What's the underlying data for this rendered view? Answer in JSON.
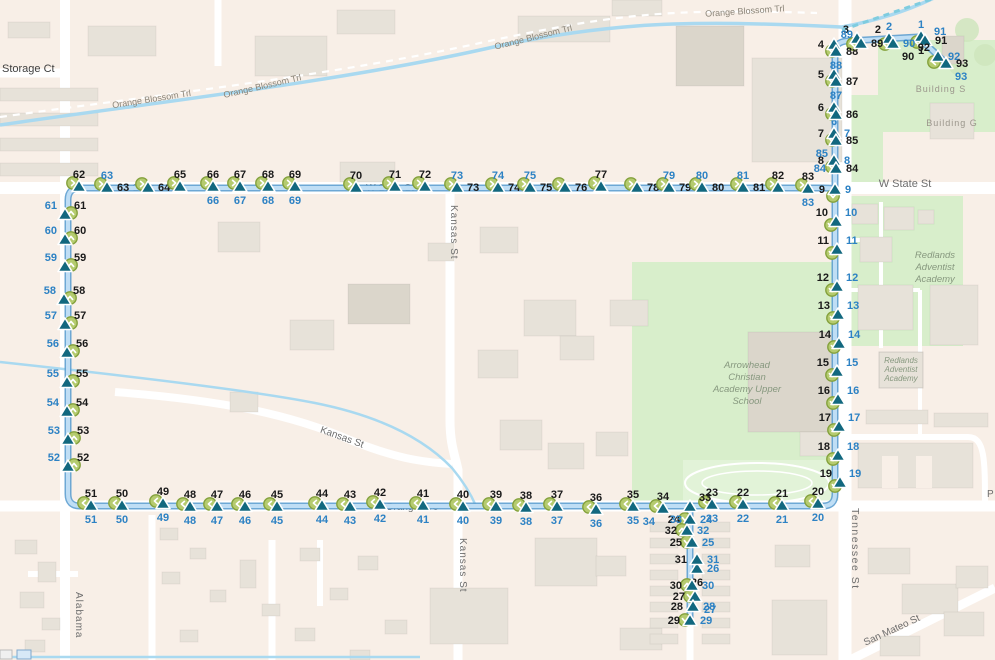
{
  "map": {
    "colors": {
      "bg": "#f8efe7",
      "building": "#e7e2d9",
      "buildingDark": "#dbd6cb",
      "road": "#ffffff",
      "green": "#d8eecb",
      "greenField": "#e2f3d8",
      "water": "#a9d9f0",
      "waterDash": "#7fccdf",
      "routeCasing": "#5d9fd0",
      "routeFill": "#bfdef5",
      "marker": "#12687f",
      "markerStroke": "#ffffff",
      "circleFill": "#b5cb6f",
      "circleRing": "#84a13c",
      "labelBlack": "#1a1a1a",
      "labelBlue": "#2d82c4",
      "labelDark": "#3f3f3f",
      "labelRoad": "#6e6e6e",
      "labelMinor": "#8a8478",
      "labelBuilding": "#9b968c",
      "labelArea": "#87987f"
    },
    "street_labels": [
      {
        "text": "Storage Ct",
        "x": 2,
        "y": 72,
        "size": 11,
        "cls": "dark",
        "anchor": "start"
      },
      {
        "text": "Orange Blossom Trl",
        "x": 152,
        "y": 102,
        "rot": -9,
        "size": 9,
        "cls": "minor",
        "anchor": "middle"
      },
      {
        "text": "Orange Blossom Trl",
        "x": 263,
        "y": 89,
        "rot": -13,
        "size": 9,
        "cls": "minor",
        "anchor": "middle"
      },
      {
        "text": "Orange Blossom Trl",
        "x": 534,
        "y": 40,
        "rot": -14,
        "size": 9,
        "cls": "minor",
        "anchor": "middle"
      },
      {
        "text": "Orange Blossom Trl",
        "x": 745,
        "y": 14,
        "rot": -4,
        "size": 9,
        "cls": "minor",
        "anchor": "middle"
      },
      {
        "text": "W State St",
        "x": 905,
        "y": 187,
        "size": 11,
        "cls": "road",
        "anchor": "middle"
      },
      {
        "text": "W State St",
        "x": 390,
        "y": 191,
        "size": 10,
        "cls": "road",
        "anchor": "middle",
        "under": true
      },
      {
        "text": "State St",
        "x": 150,
        "y": 191,
        "size": 10,
        "cls": "road",
        "anchor": "middle",
        "under": true
      },
      {
        "text": "Orange Ave",
        "x": 412,
        "y": 510,
        "size": 10,
        "cls": "road",
        "anchor": "middle",
        "under": true
      },
      {
        "text": "Kansas St",
        "x": 451,
        "y": 205,
        "rot": 90,
        "size": 10,
        "cls": "road",
        "anchor": "start",
        "spacing": 1
      },
      {
        "text": "Kansas St",
        "x": 341,
        "y": 440,
        "rot": 20,
        "size": 10,
        "cls": "road",
        "anchor": "middle"
      },
      {
        "text": "Kansas St",
        "x": 460,
        "y": 538,
        "rot": 90,
        "size": 10,
        "cls": "road",
        "anchor": "start",
        "spacing": 1
      },
      {
        "text": "Tennessee St",
        "x": 852,
        "y": 508,
        "rot": 90,
        "size": 10.5,
        "cls": "road",
        "anchor": "start",
        "spacing": 1.5
      },
      {
        "text": "Alabama",
        "x": 76,
        "y": 592,
        "rot": 90,
        "size": 10,
        "cls": "road",
        "anchor": "start",
        "spacing": 1
      },
      {
        "text": "San Mateo St",
        "x": 893,
        "y": 633,
        "rot": -25,
        "size": 10,
        "cls": "road",
        "anchor": "middle"
      },
      {
        "text": "P",
        "x": 987,
        "y": 497,
        "size": 10,
        "cls": "road",
        "anchor": "start"
      },
      {
        "text": "Building S",
        "x": 941,
        "y": 92,
        "size": 9,
        "cls": "building",
        "anchor": "middle",
        "spacing": 1
      },
      {
        "text": "Building G",
        "x": 952,
        "y": 126,
        "size": 9,
        "cls": "building",
        "anchor": "middle",
        "spacing": 1
      }
    ],
    "area_labels": [
      {
        "lines": [
          "Redlands",
          "Adventist",
          "Academy"
        ],
        "x": 935,
        "y": 258,
        "size": 9.5,
        "lh": 12
      },
      {
        "lines": [
          "Redlands",
          "Adventist",
          "Academy"
        ],
        "x": 901,
        "y": 363,
        "size": 8,
        "lh": 9,
        "box": [
          879,
          352,
          44,
          36
        ]
      },
      {
        "lines": [
          "Arrowhead",
          "Christian",
          "Academy Upper",
          "School"
        ],
        "x": 747,
        "y": 368,
        "size": 9.5,
        "lh": 12
      }
    ],
    "stations": [
      [
        1,
        921,
        37,
        "b",
        "t",
        1
      ],
      [
        2,
        889,
        39,
        "tl",
        "t",
        1
      ],
      [
        3,
        857,
        39,
        "tl",
        null,
        1
      ],
      [
        4,
        834,
        45,
        "l",
        null,
        1
      ],
      [
        5,
        834,
        75,
        "l",
        null,
        1
      ],
      [
        6,
        834,
        108,
        "l",
        "b",
        1
      ],
      [
        7,
        834,
        134,
        "l",
        "r",
        1
      ],
      [
        8,
        834,
        161,
        "l",
        "r",
        1
      ],
      [
        9,
        835,
        190,
        "l",
        "r",
        1
      ],
      [
        10,
        836,
        222,
        "tl",
        "tr",
        1
      ],
      [
        11,
        837,
        250,
        "tl",
        "tr",
        1
      ],
      [
        12,
        837,
        287,
        "tl",
        "tr",
        1
      ],
      [
        13,
        838,
        315,
        "tl",
        "tr",
        1
      ],
      [
        14,
        839,
        344,
        "tl",
        "tr",
        1
      ],
      [
        15,
        837,
        372,
        "tl",
        "tr",
        1
      ],
      [
        16,
        838,
        400,
        "tl",
        "tr",
        1
      ],
      [
        17,
        839,
        427,
        "tl",
        "tr",
        1
      ],
      [
        18,
        838,
        456,
        "tl",
        "tr",
        1
      ],
      [
        19,
        840,
        483,
        "tl",
        "tr",
        1
      ],
      [
        20,
        818,
        504,
        "t",
        "b",
        1
      ],
      [
        21,
        782,
        506,
        "t",
        "b",
        1
      ],
      [
        22,
        743,
        505,
        "t",
        "b",
        1
      ],
      [
        23,
        712,
        505,
        "t",
        "b",
        1
      ],
      [
        24,
        690,
        520,
        "l",
        "r",
        1
      ],
      [
        25,
        692,
        543,
        "l",
        "r",
        1
      ],
      [
        26,
        697,
        569,
        "b",
        "r",
        0
      ],
      [
        27,
        695,
        597,
        "l",
        "br",
        1
      ],
      [
        28,
        693,
        607,
        "l",
        "r",
        0
      ],
      [
        29,
        690,
        621,
        "l",
        "r",
        1
      ],
      [
        30,
        692,
        586,
        "l",
        "r",
        1
      ],
      [
        31,
        697,
        560,
        "l",
        "r",
        0
      ],
      [
        32,
        687,
        531,
        "l",
        "r",
        1
      ],
      [
        33,
        690,
        507,
        "tr",
        "bl",
        0
      ],
      [
        34,
        663,
        509,
        "t",
        "bl",
        1
      ],
      [
        35,
        633,
        507,
        "t",
        "b",
        1
      ],
      [
        36,
        596,
        510,
        "t",
        "b",
        1
      ],
      [
        37,
        557,
        507,
        "t",
        "b",
        1
      ],
      [
        38,
        526,
        508,
        "t",
        "b",
        1
      ],
      [
        39,
        496,
        507,
        "t",
        "b",
        1
      ],
      [
        40,
        463,
        507,
        "t",
        "b",
        1
      ],
      [
        41,
        423,
        506,
        "t",
        "b",
        1
      ],
      [
        42,
        380,
        505,
        "t",
        "b",
        1
      ],
      [
        43,
        350,
        507,
        "t",
        "b",
        1
      ],
      [
        44,
        322,
        506,
        "t",
        "b",
        1
      ],
      [
        45,
        277,
        507,
        "t",
        "b",
        1
      ],
      [
        46,
        245,
        507,
        "t",
        "b",
        1
      ],
      [
        47,
        217,
        507,
        "t",
        "b",
        1
      ],
      [
        48,
        190,
        507,
        "t",
        "b",
        1
      ],
      [
        49,
        163,
        504,
        "t",
        "b",
        1
      ],
      [
        50,
        122,
        506,
        "t",
        "b",
        1
      ],
      [
        51,
        91,
        506,
        "t",
        "b",
        1
      ],
      [
        52,
        68,
        467,
        "tr",
        "tl",
        1
      ],
      [
        53,
        68,
        440,
        "tr",
        "tl",
        1
      ],
      [
        54,
        67,
        412,
        "tr",
        "tl",
        1
      ],
      [
        55,
        67,
        383,
        "tr",
        "tl",
        1
      ],
      [
        56,
        67,
        353,
        "tr",
        "tl",
        1
      ],
      [
        57,
        65,
        325,
        "tr",
        "tl",
        1
      ],
      [
        58,
        64,
        300,
        "tr",
        "tl",
        1
      ],
      [
        59,
        65,
        267,
        "tr",
        "tl",
        1
      ],
      [
        60,
        65,
        240,
        "tr",
        "tl",
        1
      ],
      [
        61,
        65,
        215,
        "tr",
        "tl",
        1
      ],
      [
        62,
        79,
        187,
        "t",
        null,
        1
      ],
      [
        63,
        107,
        188,
        "r",
        "t",
        1
      ],
      [
        64,
        148,
        188,
        "r",
        null,
        1
      ],
      [
        65,
        180,
        187,
        "t",
        null,
        1
      ],
      [
        66,
        213,
        187,
        "t",
        "b",
        1
      ],
      [
        67,
        240,
        187,
        "t",
        "b",
        1
      ],
      [
        68,
        268,
        187,
        "t",
        "b",
        1
      ],
      [
        69,
        295,
        187,
        "t",
        "b",
        1
      ],
      [
        70,
        356,
        188,
        "t",
        null,
        1
      ],
      [
        71,
        395,
        187,
        "t",
        null,
        1
      ],
      [
        72,
        425,
        187,
        "t",
        null,
        1
      ],
      [
        73,
        457,
        188,
        "r",
        "t",
        1
      ],
      [
        74,
        498,
        188,
        "r",
        "t",
        1
      ],
      [
        75,
        530,
        188,
        "r",
        "t",
        1
      ],
      [
        76,
        565,
        188,
        "r",
        null,
        1
      ],
      [
        77,
        601,
        187,
        "t",
        null,
        1
      ],
      [
        78,
        637,
        188,
        "r",
        null,
        1
      ],
      [
        79,
        669,
        188,
        "r",
        "t",
        1
      ],
      [
        80,
        702,
        188,
        "r",
        "t",
        1
      ],
      [
        81,
        743,
        188,
        "r",
        "t",
        1
      ],
      [
        82,
        778,
        188,
        "t",
        null,
        1
      ],
      [
        83,
        808,
        189,
        "t",
        "b",
        1
      ],
      [
        84,
        836,
        169,
        "r",
        "l",
        0
      ],
      [
        85,
        836,
        141,
        "r",
        "bl",
        0
      ],
      [
        86,
        836,
        115,
        "r",
        null,
        0
      ],
      [
        87,
        836,
        82,
        "r",
        "b",
        0
      ],
      [
        88,
        836,
        52,
        "r",
        "b",
        0
      ],
      [
        89,
        861,
        44,
        "r",
        "tl",
        0
      ],
      [
        90,
        893,
        44,
        "br",
        "r",
        0
      ],
      [
        91,
        925,
        41,
        "r",
        "tr",
        0
      ],
      [
        92,
        938,
        57,
        "tl",
        "r",
        1
      ],
      [
        93,
        946,
        64,
        "r",
        "br",
        0
      ]
    ]
  }
}
